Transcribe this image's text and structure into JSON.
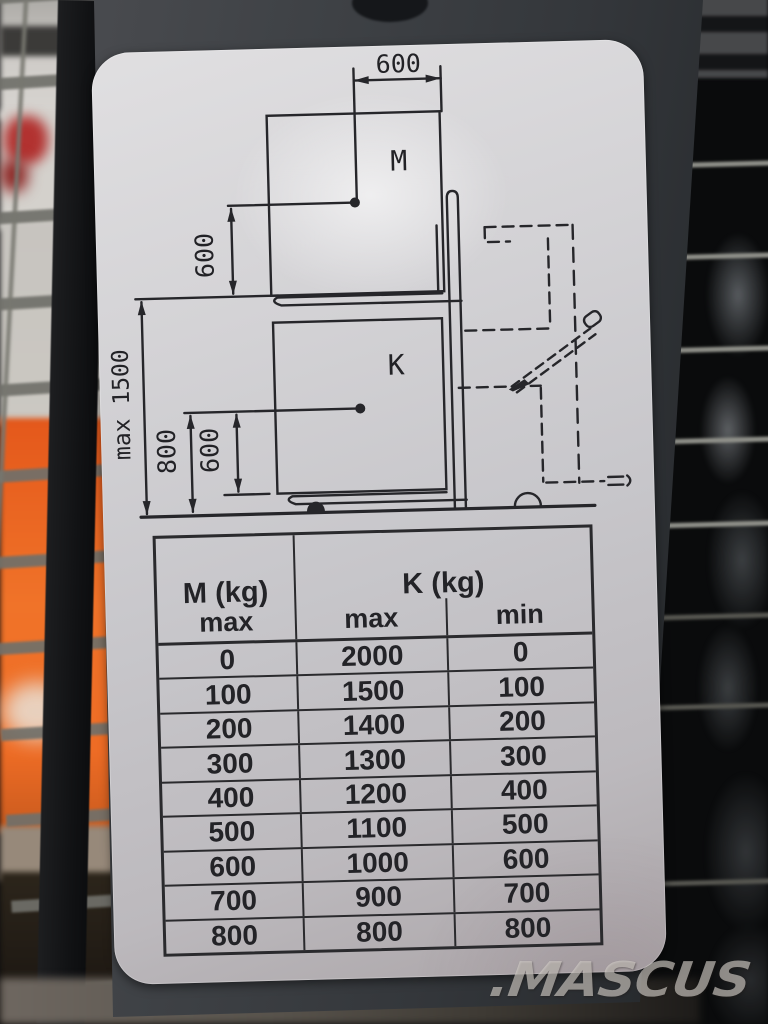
{
  "diagram": {
    "dim_top_width": "600",
    "dim_upper_height": "600",
    "label_upper_load": "M",
    "dim_total_height": "max 1500",
    "dim_lower_800": "800",
    "dim_lower_600": "600",
    "label_lower_load": "K"
  },
  "table": {
    "header": {
      "m": "M (kg)",
      "m_sub": "max",
      "k": "K (kg)",
      "k_max": "max",
      "k_min": "min"
    },
    "rows": [
      [
        "0",
        "2000",
        "0"
      ],
      [
        "100",
        "1500",
        "100"
      ],
      [
        "200",
        "1400",
        "200"
      ],
      [
        "300",
        "1300",
        "300"
      ],
      [
        "400",
        "1200",
        "400"
      ],
      [
        "500",
        "1100",
        "500"
      ],
      [
        "600",
        "1000",
        "600"
      ],
      [
        "700",
        "900",
        "700"
      ],
      [
        "800",
        "800",
        "800"
      ]
    ]
  },
  "watermark": {
    "text": ".MASCUS"
  },
  "colors": {
    "label_silver": "#c9c8cb",
    "panel_charcoal": "#383b3f",
    "background_orange": "#ee6e27",
    "diagram_ink": "#26262a",
    "watermark_gray": "#d8d3cd"
  }
}
